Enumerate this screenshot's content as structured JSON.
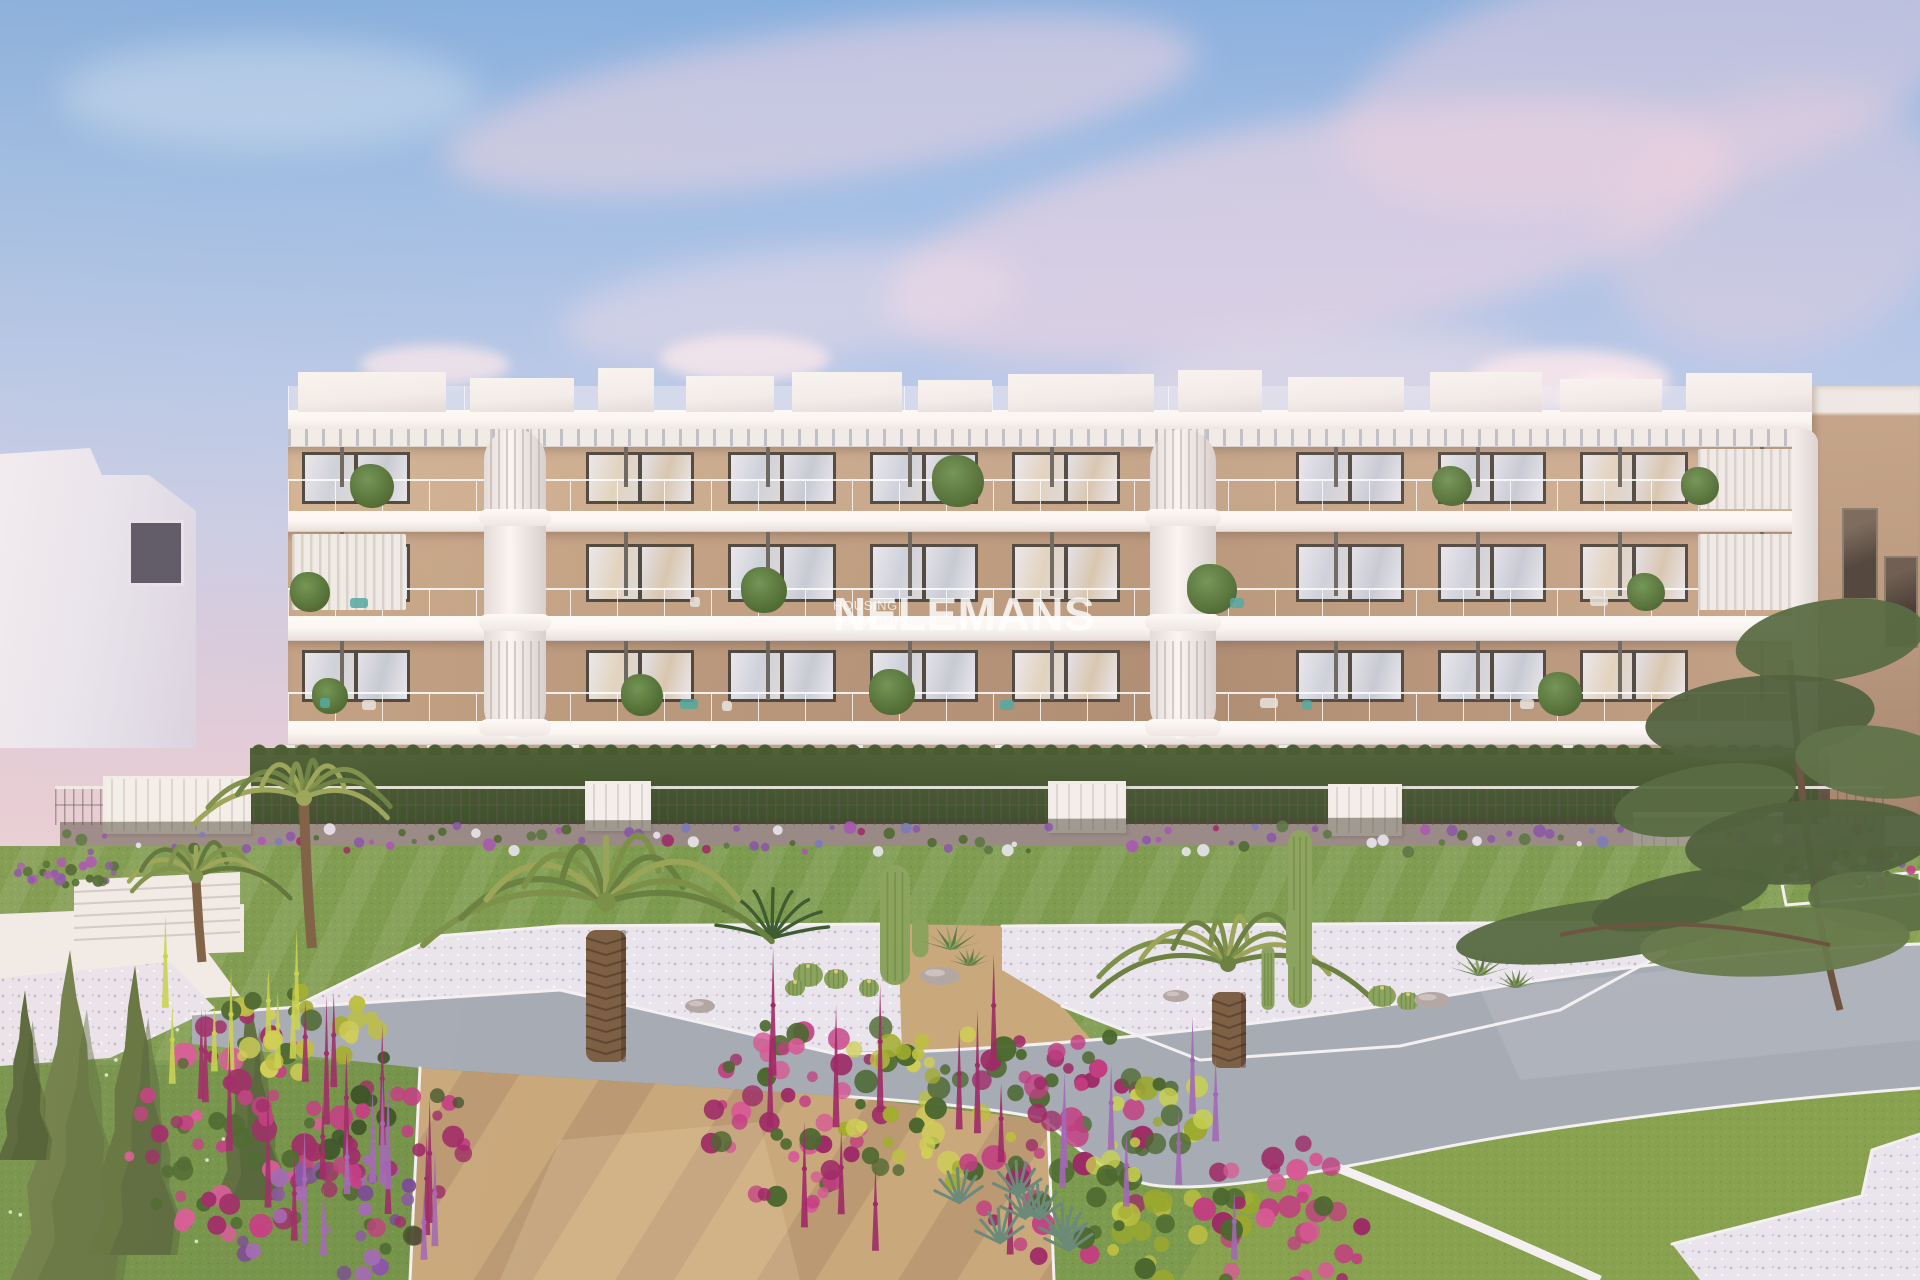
{
  "watermark": {
    "brand": "NELEMANS",
    "tagline": "HOUSING SOLUTIONS"
  },
  "scene": {
    "subject": "Modern four-storey white apartment building with glass balconies, pergola roof terraces and landscaped cactus garden at sunset"
  },
  "palette": {
    "sky_top": "#84aede",
    "sky_mid": "#b7c8e8",
    "sky_horizon": "#e6cdd6",
    "cloud_pink": "#efd3dc",
    "building_white": "#f3ede9",
    "slab_white": "#fbf7f3",
    "wall_beige": "#c9a888",
    "wall_beige_dark": "#ad8b6f",
    "window_frame": "#4e463c",
    "glass_light": "#eae8ec",
    "glass_mid": "#cdd1da",
    "rail_tint": "#e4e9ea",
    "louver_line": "#d8d1ca",
    "hedge_dark": "#3c4e2b",
    "lawn_green": "#7d9b4e",
    "gravel_white": "#eae4ec",
    "path_gray": "#a6abb4",
    "sand_tan": "#c9a87c",
    "curb_white": "#f4f0f2",
    "soil": "#4a4434",
    "flower_pink": "#c33d82",
    "flower_magenta": "#9e2a66",
    "flower_yellow": "#bcbf40",
    "flower_purple": "#8a55a6",
    "foliage": "#4c682f",
    "cypress": "#6e7e48",
    "pine": "#54683e",
    "palm_green": "#7c9048",
    "palm_yellow": "#9aa457",
    "trunk_brown": "#7d5f44",
    "cactus_green": "#8ba35d",
    "rock_gray": "#b3a7a4",
    "teal_furniture": "#4fa8a0",
    "bg_left": "#e9e6ef",
    "bg_right_top": "#c3a284",
    "bg_right_bottom": "#a5846c",
    "watermark": "#ffffff"
  }
}
